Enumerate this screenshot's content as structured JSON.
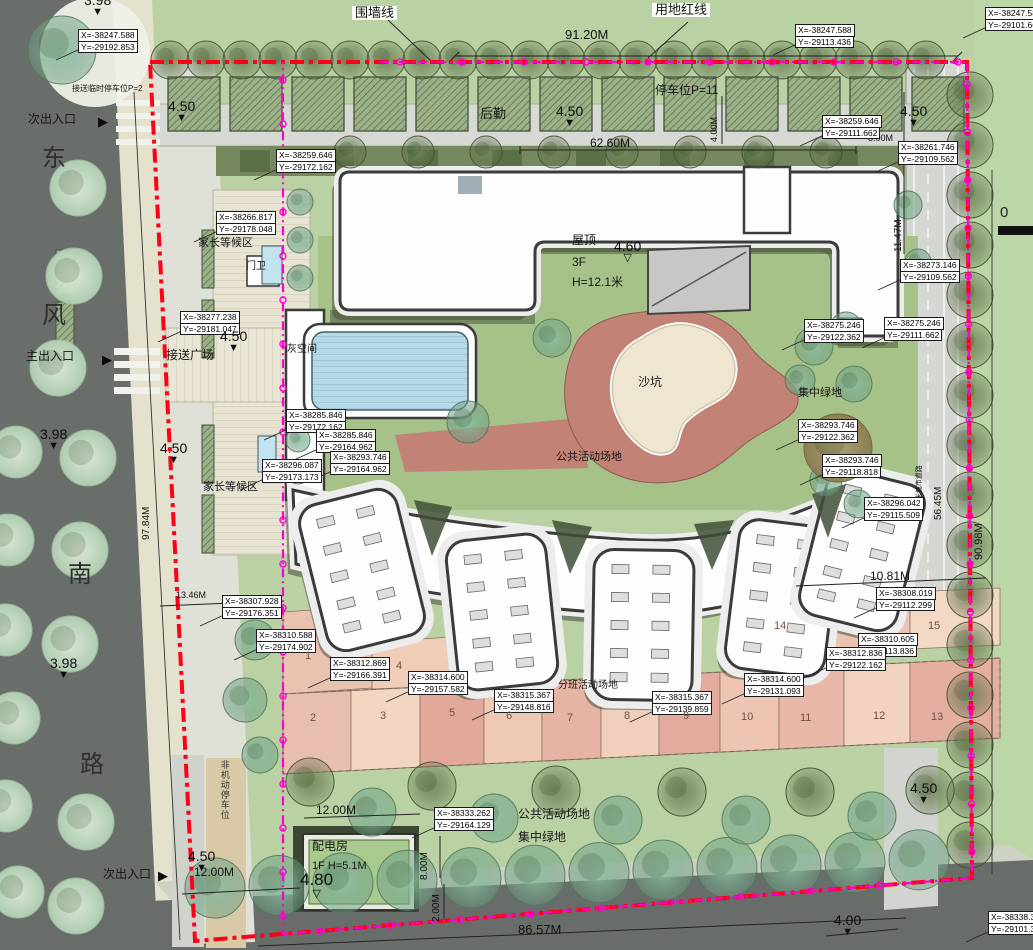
{
  "colors": {
    "red_boundary_line": "#ff0016",
    "wall_line": "#ff00cf",
    "building_fill": "#fdfdfd",
    "sand_zone": "#c28275",
    "cell_pink": "#e8bfae"
  },
  "scale": {
    "zero_label": "0"
  },
  "annotations": [
    {
      "t": "围墙线",
      "x": 352,
      "y": 6,
      "s": 13,
      "cls": "boxed"
    },
    {
      "t": "用地红线",
      "x": 652,
      "y": 3,
      "s": 13,
      "cls": "boxed"
    },
    {
      "t": "91.20M",
      "x": 565,
      "y": 28,
      "s": 13,
      "cls": "dim"
    },
    {
      "t": "停车位P=11",
      "x": 655,
      "y": 84,
      "s": 12,
      "cls": "area"
    },
    {
      "t": "接送临时停车位P=2",
      "x": 72,
      "y": 85,
      "s": 8,
      "cls": "area"
    },
    {
      "t": "后勤",
      "x": 480,
      "y": 107,
      "s": 13,
      "cls": "area"
    },
    {
      "t": "62.60M",
      "x": 590,
      "y": 137,
      "s": 12,
      "cls": "dim"
    },
    {
      "t": "4.00M",
      "x": 710,
      "y": 142,
      "s": 9,
      "cls": "dim",
      "r": -90
    },
    {
      "t": "11.47M",
      "x": 894,
      "y": 252,
      "s": 10,
      "cls": "dim",
      "r": -90
    },
    {
      "t": "8.00M",
      "x": 868,
      "y": 134,
      "s": 9,
      "cls": "dim"
    },
    {
      "t": "次出入口",
      "x": 28,
      "y": 113,
      "s": 12,
      "cls": "area"
    },
    {
      "t": "东",
      "x": 42,
      "y": 146,
      "s": 24,
      "cls": "road"
    },
    {
      "t": "风",
      "x": 42,
      "y": 303,
      "s": 24,
      "cls": "road"
    },
    {
      "t": "南",
      "x": 68,
      "y": 562,
      "s": 24,
      "cls": "road"
    },
    {
      "t": "路",
      "x": 80,
      "y": 752,
      "s": 24,
      "cls": "road"
    },
    {
      "t": "主出入口",
      "x": 26,
      "y": 350,
      "s": 12,
      "cls": "area"
    },
    {
      "t": "次出入口",
      "x": 103,
      "y": 868,
      "s": 12,
      "cls": "area"
    },
    {
      "t": "家长等候区",
      "x": 198,
      "y": 238,
      "s": 11,
      "cls": "area"
    },
    {
      "t": "门卫",
      "x": 246,
      "y": 262,
      "s": 10,
      "cls": "area"
    },
    {
      "t": "接送广场",
      "x": 166,
      "y": 349,
      "s": 12,
      "cls": "area"
    },
    {
      "t": "灰空间",
      "x": 287,
      "y": 345,
      "s": 10,
      "cls": "area"
    },
    {
      "t": "家长等候区",
      "x": 203,
      "y": 482,
      "s": 11,
      "cls": "area"
    },
    {
      "t": "屋顶",
      "x": 572,
      "y": 234,
      "s": 12,
      "cls": "area"
    },
    {
      "t": "3F",
      "x": 572,
      "y": 256,
      "s": 12,
      "cls": "area"
    },
    {
      "t": "H=12.1米",
      "x": 572,
      "y": 276,
      "s": 12,
      "cls": "area"
    },
    {
      "t": "沙坑",
      "x": 638,
      "y": 376,
      "s": 12,
      "cls": "area"
    },
    {
      "t": "公共活动场地",
      "x": 556,
      "y": 452,
      "s": 11,
      "cls": "area"
    },
    {
      "t": "集中绿地",
      "x": 798,
      "y": 388,
      "s": 11,
      "cls": "area"
    },
    {
      "t": "56.45M",
      "x": 934,
      "y": 520,
      "s": 10,
      "cls": "dim",
      "r": -90
    },
    {
      "t": "30米城市道路",
      "x": 916,
      "y": 508,
      "s": 7,
      "cls": "dim",
      "r": -90
    },
    {
      "t": "90.98M",
      "x": 974,
      "y": 560,
      "s": 11,
      "cls": "dim",
      "r": -90
    },
    {
      "t": "97.84M",
      "x": 142,
      "y": 540,
      "s": 10,
      "cls": "dim",
      "r": -90
    },
    {
      "t": "13.46M",
      "x": 176,
      "y": 591,
      "s": 9,
      "cls": "dim"
    },
    {
      "t": "10.81M",
      "x": 870,
      "y": 570,
      "s": 12,
      "cls": "dim"
    },
    {
      "t": "分班活动场地",
      "x": 558,
      "y": 681,
      "s": 10,
      "cls": "area"
    },
    {
      "t": "12.00M",
      "x": 316,
      "y": 804,
      "s": 12,
      "cls": "dim"
    },
    {
      "t": "12.00M",
      "x": 194,
      "y": 866,
      "s": 12,
      "cls": "dim"
    },
    {
      "t": "8.00M",
      "x": 420,
      "y": 880,
      "s": 10,
      "cls": "dim",
      "r": -90
    },
    {
      "t": "2.00M",
      "x": 432,
      "y": 922,
      "s": 10,
      "cls": "dim",
      "r": -90
    },
    {
      "t": "86.57M",
      "x": 518,
      "y": 923,
      "s": 13,
      "cls": "dim"
    },
    {
      "t": "非机动停车位",
      "x": 219,
      "y": 760,
      "s": 9,
      "cls": "vert"
    },
    {
      "t": "配电房",
      "x": 312,
      "y": 840,
      "s": 12,
      "cls": "area"
    },
    {
      "t": "1F   H=5.1M",
      "x": 312,
      "y": 861,
      "s": 11,
      "cls": "area"
    },
    {
      "t": "公共活动场地",
      "x": 518,
      "y": 808,
      "s": 12,
      "cls": "area"
    },
    {
      "t": "集中绿地",
      "x": 518,
      "y": 831,
      "s": 12,
      "cls": "area"
    }
  ],
  "coordinate_labels": [
    {
      "X": "X=-38247.588",
      "Y": "Y=-29192.853",
      "x": 78,
      "y": 30
    },
    {
      "X": "X=-38247.588",
      "Y": "Y=-29113.436",
      "x": 795,
      "y": 25
    },
    {
      "X": "X=-38247.588",
      "Y": "Y=-29101.662",
      "x": 985,
      "y": 8
    },
    {
      "X": "X=-38259.646",
      "Y": "Y=-29111.662",
      "x": 822,
      "y": 116
    },
    {
      "X": "X=-38261.746",
      "Y": "Y=-29109.562",
      "x": 898,
      "y": 142
    },
    {
      "X": "X=-38259.646",
      "Y": "Y=-29172.162",
      "x": 276,
      "y": 150
    },
    {
      "X": "X=-38266.817",
      "Y": "Y=-29178.048",
      "x": 216,
      "y": 212
    },
    {
      "X": "X=-38277.238",
      "Y": "Y=-29181.047",
      "x": 180,
      "y": 312
    },
    {
      "X": "X=-38285.846",
      "Y": "Y=-29172.162",
      "x": 286,
      "y": 410
    },
    {
      "X": "X=-38285.846",
      "Y": "Y=-29164.962",
      "x": 316,
      "y": 430
    },
    {
      "X": "X=-38293.746",
      "Y": "Y=-29164.962",
      "x": 330,
      "y": 452
    },
    {
      "X": "X=-38296.087",
      "Y": "Y=-29173.173",
      "x": 262,
      "y": 460
    },
    {
      "X": "X=-38273.146",
      "Y": "Y=-29109.562",
      "x": 900,
      "y": 260
    },
    {
      "X": "X=-38275.246",
      "Y": "Y=-29111.662",
      "x": 884,
      "y": 318
    },
    {
      "X": "X=-38275.246",
      "Y": "Y=-29122.362",
      "x": 804,
      "y": 320
    },
    {
      "X": "X=-38293.746",
      "Y": "Y=-29122.362",
      "x": 798,
      "y": 420
    },
    {
      "X": "X=-38293.746",
      "Y": "Y=-29118.818",
      "x": 822,
      "y": 455
    },
    {
      "X": "X=-38296.042",
      "Y": "Y=-29115.509",
      "x": 864,
      "y": 498
    },
    {
      "X": "X=-38308.019",
      "Y": "Y=-29112.299",
      "x": 876,
      "y": 588
    },
    {
      "X": "X=-38310.605",
      "Y": "Y=-29113.836",
      "x": 858,
      "y": 634
    },
    {
      "X": "X=-38312.836",
      "Y": "Y=-29122.162",
      "x": 826,
      "y": 648
    },
    {
      "X": "X=-38314.600",
      "Y": "Y=-29131.093",
      "x": 744,
      "y": 674
    },
    {
      "X": "X=-38315.367",
      "Y": "Y=-29139.859",
      "x": 652,
      "y": 692
    },
    {
      "X": "X=-38315.367",
      "Y": "Y=-29148.816",
      "x": 494,
      "y": 690
    },
    {
      "X": "X=-38314.600",
      "Y": "Y=-29157.582",
      "x": 408,
      "y": 672
    },
    {
      "X": "X=-38312.869",
      "Y": "Y=-29166.391",
      "x": 330,
      "y": 658
    },
    {
      "X": "X=-38310.588",
      "Y": "Y=-29174.902",
      "x": 256,
      "y": 630
    },
    {
      "X": "X=-38307.928",
      "Y": "Y=-29176.351",
      "x": 222,
      "y": 596
    },
    {
      "X": "X=-38333.262",
      "Y": "Y=-29164.129",
      "x": 434,
      "y": 808
    },
    {
      "X": "X=-38338.358",
      "Y": "Y=-29101.338",
      "x": 988,
      "y": 912
    }
  ],
  "spot_elevations": [
    {
      "v": "3.98",
      "x": 84,
      "y": -8,
      "open": false
    },
    {
      "v": "4.50",
      "x": 168,
      "y": 98,
      "open": false
    },
    {
      "v": "4.50",
      "x": 556,
      "y": 103,
      "open": false
    },
    {
      "v": "4.50",
      "x": 900,
      "y": 103,
      "open": false
    },
    {
      "v": "4.50",
      "x": 220,
      "y": 328,
      "open": false
    },
    {
      "v": "4.50",
      "x": 160,
      "y": 440,
      "open": false
    },
    {
      "v": "3.98",
      "x": 40,
      "y": 426,
      "open": false
    },
    {
      "v": "3.98",
      "x": 50,
      "y": 655,
      "open": false
    },
    {
      "v": "4.60",
      "x": 614,
      "y": 238,
      "open": true
    },
    {
      "v": "4.80",
      "x": 300,
      "y": 870,
      "open": true,
      "big": true
    },
    {
      "v": "4.50",
      "x": 188,
      "y": 848,
      "open": false
    },
    {
      "v": "4.50",
      "x": 910,
      "y": 780,
      "open": false
    },
    {
      "v": "4.00",
      "x": 834,
      "y": 912,
      "open": false
    }
  ],
  "entrance_arrows": [
    {
      "x": 98,
      "y": 114
    },
    {
      "x": 102,
      "y": 352
    },
    {
      "x": 158,
      "y": 868
    }
  ],
  "cell_numbers": [
    {
      "n": "1",
      "x": 305,
      "y": 650
    },
    {
      "n": "2",
      "x": 310,
      "y": 712
    },
    {
      "n": "3",
      "x": 380,
      "y": 710
    },
    {
      "n": "4",
      "x": 396,
      "y": 660
    },
    {
      "n": "5",
      "x": 449,
      "y": 707
    },
    {
      "n": "6",
      "x": 506,
      "y": 710
    },
    {
      "n": "7",
      "x": 567,
      "y": 712
    },
    {
      "n": "8",
      "x": 624,
      "y": 710
    },
    {
      "n": "9",
      "x": 683,
      "y": 710
    },
    {
      "n": "10",
      "x": 741,
      "y": 711
    },
    {
      "n": "11",
      "x": 800,
      "y": 712
    },
    {
      "n": "12",
      "x": 873,
      "y": 710
    },
    {
      "n": "13",
      "x": 931,
      "y": 711
    },
    {
      "n": "14",
      "x": 774,
      "y": 620
    },
    {
      "n": "15",
      "x": 928,
      "y": 620
    }
  ],
  "arrow_glyph": "▶",
  "spot_marker_filled": "▼",
  "spot_marker_open": "▽"
}
